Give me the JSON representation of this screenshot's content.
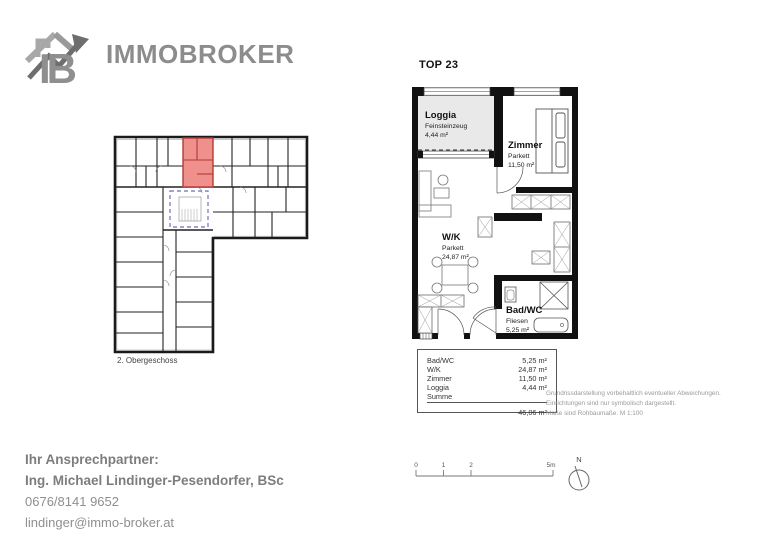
{
  "brand": {
    "monogram": "IB",
    "name": "IMMOBROKER"
  },
  "unit": {
    "title": "TOP 23"
  },
  "overview_plan": {
    "floor_label": "2. Obergeschoss"
  },
  "floorplan": {
    "rooms": [
      {
        "name": "Loggia",
        "floor": "Feinsteinzeug",
        "area": "4,44 m²"
      },
      {
        "name": "Zimmer",
        "floor": "Parkett",
        "area": "11,50 m²"
      },
      {
        "name": "W/K",
        "floor": "Parkett",
        "area": "24,87 m²"
      },
      {
        "name": "Bad/WC",
        "floor": "Fliesen",
        "area": "5,25 m²"
      }
    ]
  },
  "area_table": {
    "rows": [
      {
        "label": "Bad/WC",
        "value": "5,25 m²"
      },
      {
        "label": "W/K",
        "value": "24,87 m²"
      },
      {
        "label": "Zimmer",
        "value": "11,50 m²"
      },
      {
        "label": "Loggia",
        "value": "4,44 m²"
      }
    ],
    "sum_label": "Summe",
    "sum_value": "46,06 m²"
  },
  "disclaimer": {
    "line1": "Grundrissdarstellung vorbehaltlich eventueller Abweichungen.",
    "line2": "Einrichtungen sind nur symbolisch dargestellt.",
    "line3": "Maße sind Rohbaumaße. M 1:100"
  },
  "contact": {
    "heading": "Ihr Ansprechpartner:",
    "name": "Ing. Michael Lindinger-Pesendorfer, BSc",
    "phone": "0676/8141 9652",
    "email": "lindinger@immo-broker.at"
  },
  "scale_bar": {
    "ticks": [
      "0",
      "1",
      "2",
      "5m"
    ]
  },
  "compass": {
    "north_label": "N"
  },
  "colors": {
    "unit_highlight": "#f0908d",
    "unit_highlight_wall": "#b23b34",
    "stairwell_outline": "#8585c2"
  }
}
